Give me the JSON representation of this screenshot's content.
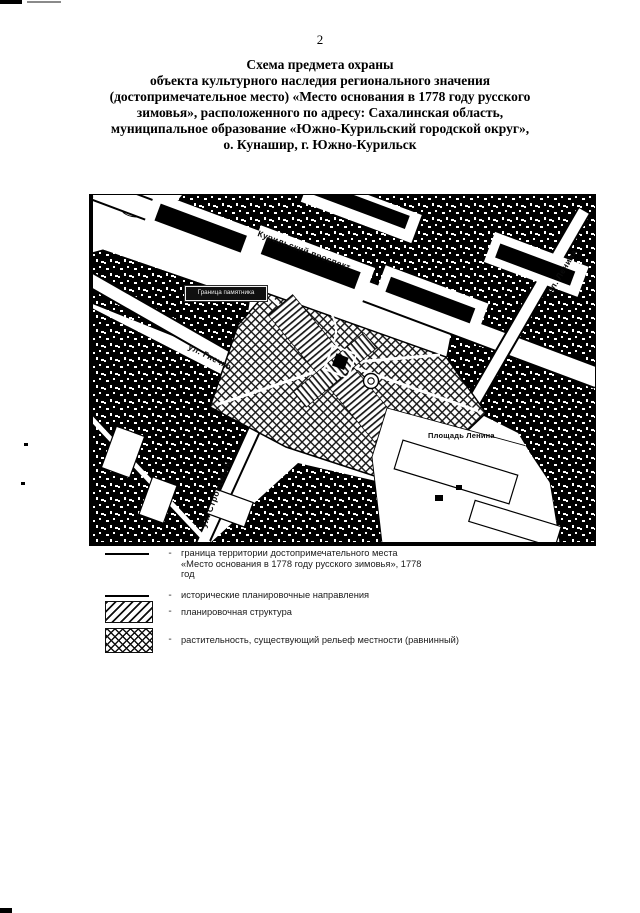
{
  "page": {
    "number": "2"
  },
  "title": {
    "lines": [
      "Схема предмета охраны",
      "объекта культурного наследия регионального значения",
      "(достопримечательное место) «Место основания в 1778 году русского",
      "зимовья», расположенного по адресу: Сахалинская область,",
      "муниципальное образование «Южно-Курильский городской округ»,",
      "о. Кунашир, г. Южно-Курильск"
    ]
  },
  "map": {
    "street_labels": {
      "kurilsky": "Курильский проспект",
      "gnechko": "ул. Гнечко",
      "stroiteley": "ул. Строителей",
      "lenina_road": "пл. Ленина"
    },
    "place_labels": {
      "lenin_square": "Площадь Ленина",
      "monument_boundary": "Граница памятника"
    }
  },
  "legend": {
    "items": [
      {
        "symbol": "solid-line",
        "text": "граница территории достопримечательного места «Место основания в 1778 году русского зимовья», 1778 год"
      },
      {
        "symbol": "solid-line",
        "text": "исторические планировочные направления"
      },
      {
        "symbol": "diagonal-hatch",
        "text": "планировочная структура"
      },
      {
        "symbol": "cross-hatch",
        "text": "растительность, существующий рельеф местности (равнинный)"
      }
    ],
    "separator": "-"
  },
  "colors": {
    "ink": "#000000",
    "paper": "#ffffff"
  }
}
